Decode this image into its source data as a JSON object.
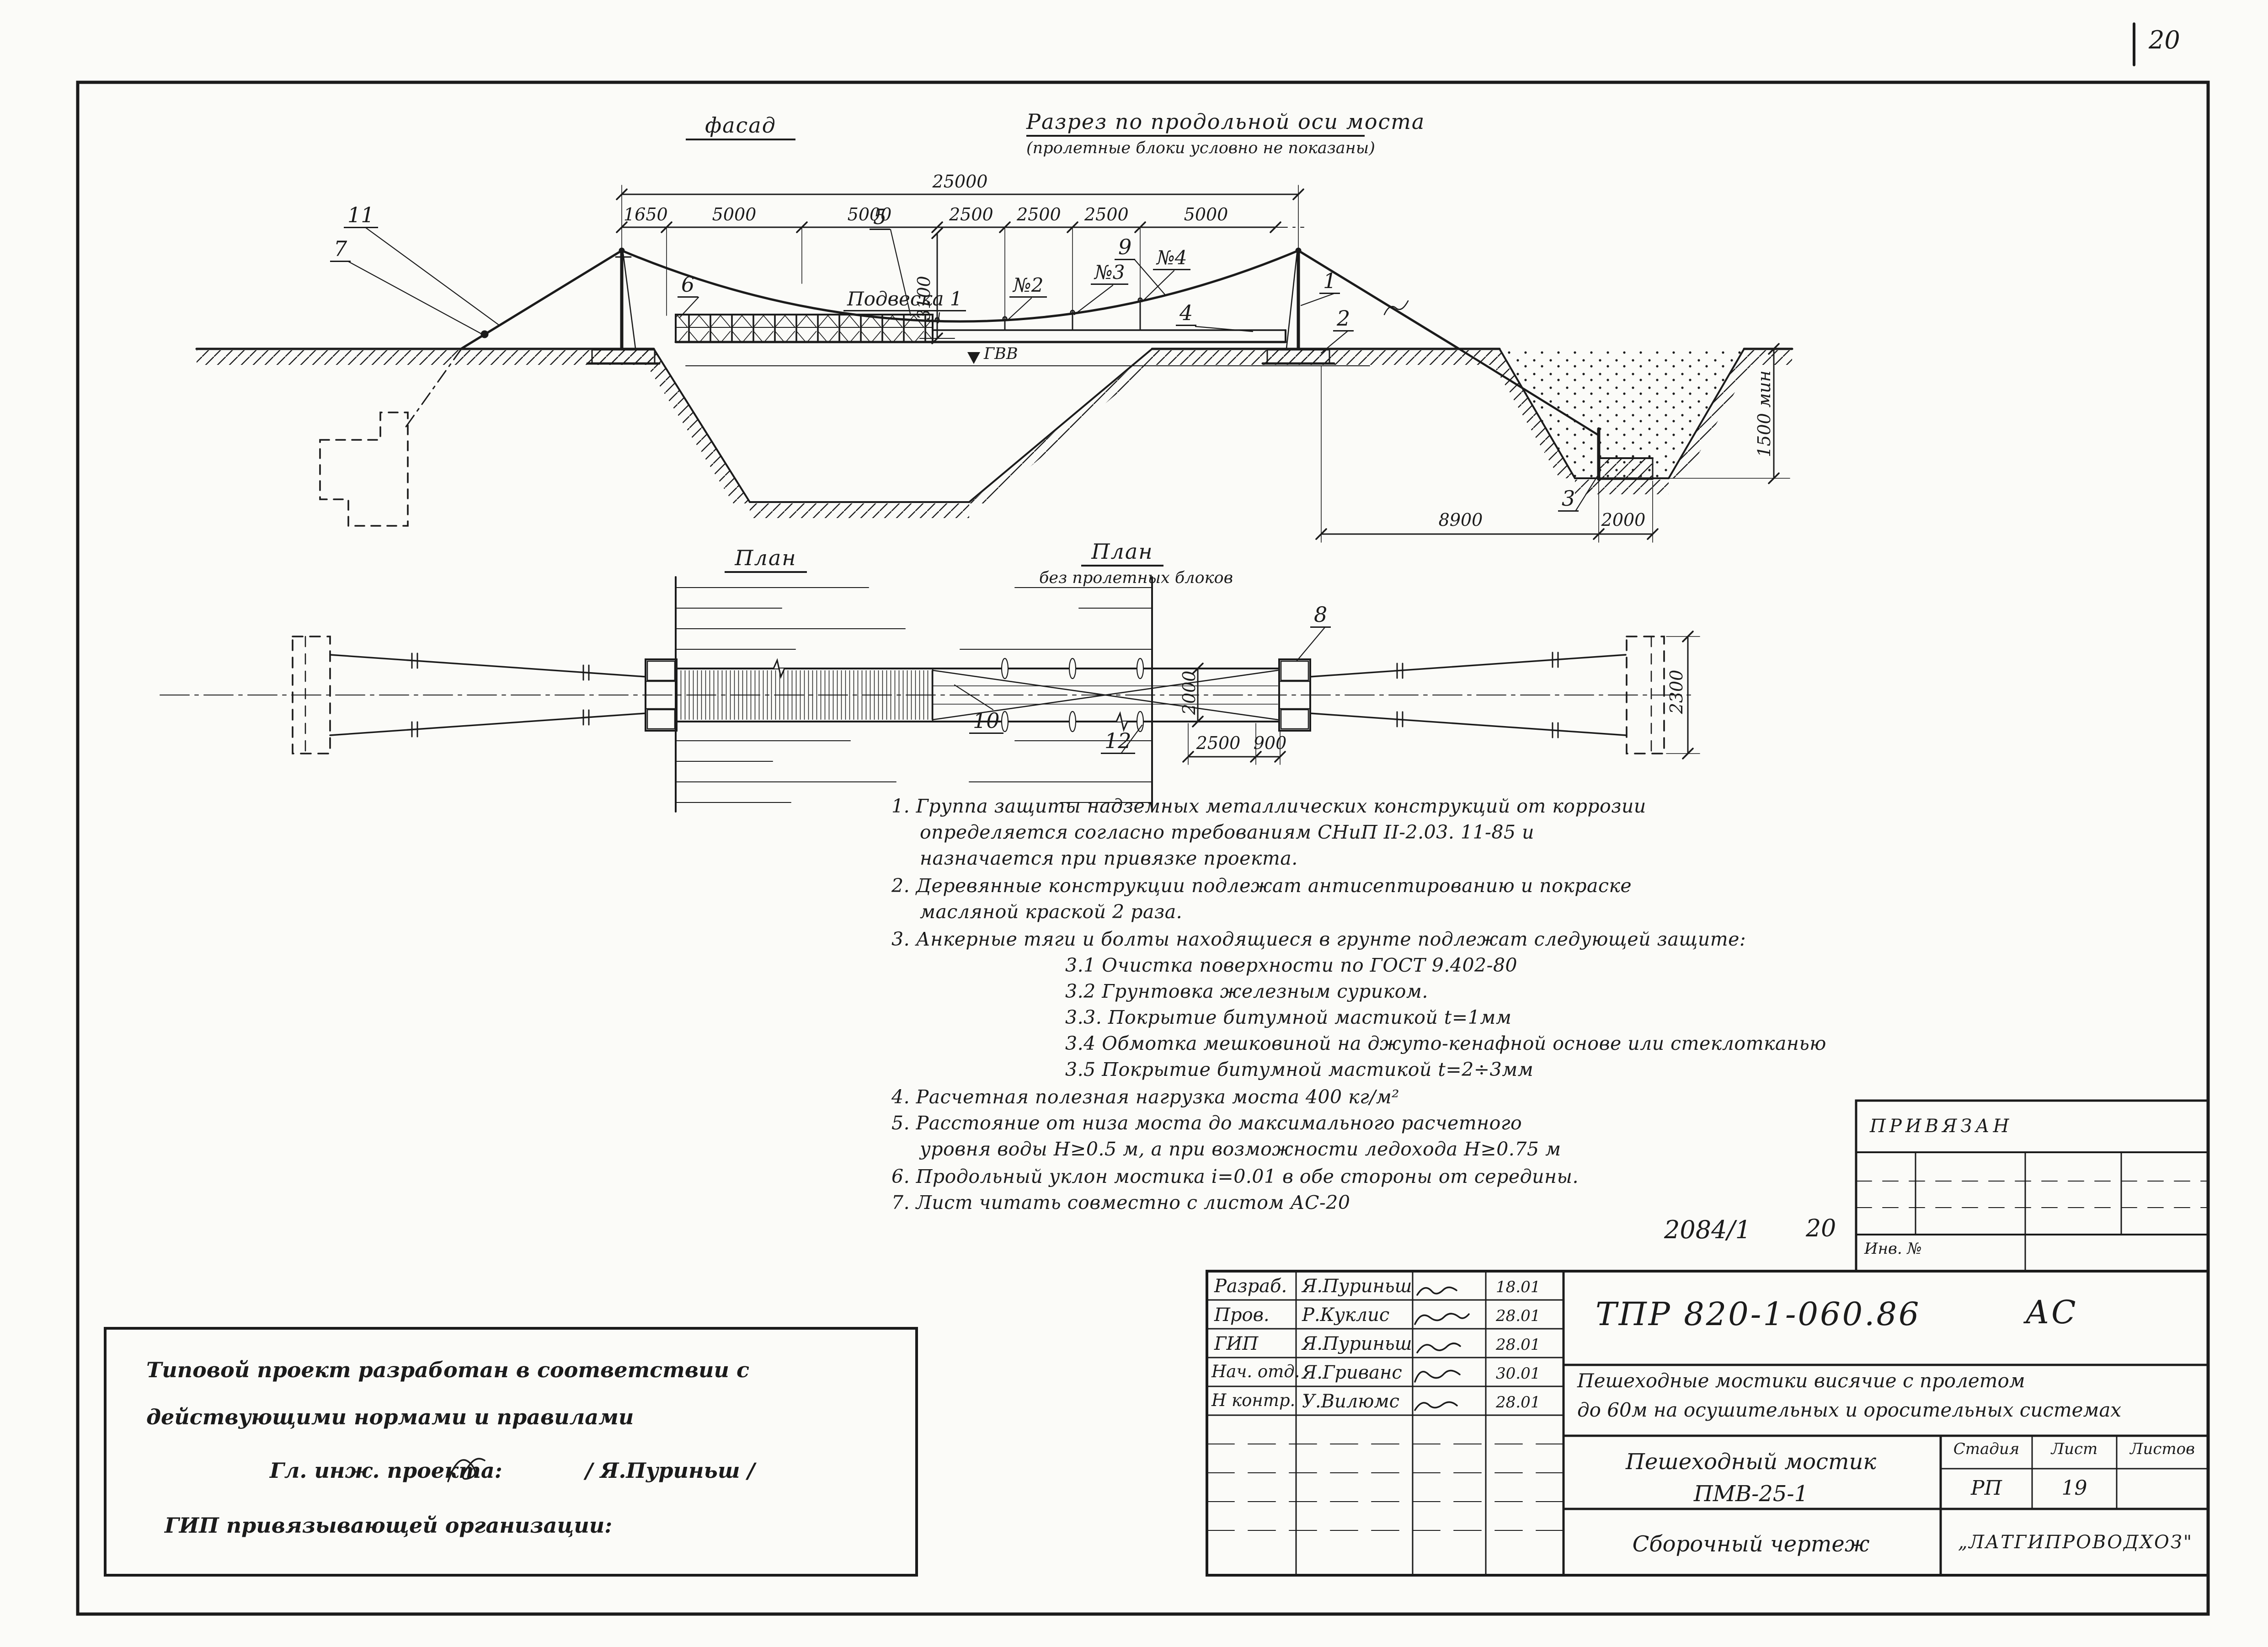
{
  "corner": {
    "sheet_no": "20",
    "doc_no": "2084/1",
    "inv_label": "Инв. №",
    "attached": "ПРИВЯЗАН"
  },
  "views": {
    "facade_title": "фасад",
    "section_title": "Разрез по продольной оси моста",
    "section_subtitle": "(пролетные блоки условно не показаны)",
    "plan_left_title": "План",
    "plan_right_title": "План",
    "plan_right_subtitle": "без пролетных блоков"
  },
  "dims": {
    "total": "25000",
    "segments": [
      "1650",
      "5000",
      "5000",
      "2500",
      "2500",
      "2500",
      "5000"
    ],
    "pylon_height": "3100",
    "pit_offset": "8900",
    "pit_width": "2000",
    "pit_depth": "1500 мин",
    "water_level": "ГВВ",
    "plan_deck_width": "2000",
    "plan_900": "900",
    "plan_2500": "2500",
    "plan_anchor": "2300"
  },
  "parts": {
    "n1": "1",
    "n2": "2",
    "n3": "3",
    "n4": "4",
    "n5": "5",
    "n6": "6",
    "n7": "7",
    "n8": "8",
    "n9": "9",
    "n10": "10",
    "n11": "11",
    "n12": "12",
    "hanger1": "Подвеска 1",
    "hanger2": "№2",
    "hanger3": "№3",
    "hanger4": "№4"
  },
  "notes": {
    "lines": [
      "1.  Группа защиты надземных металлических конструкций от коррозии",
      "определяется согласно требованиям СНиП II-2.03. 11-85 и",
      "назначается при привязке проекта.",
      "2.  Деревянные конструкции подлежат антисептированию и покраске",
      "масляной краской 2 раза.",
      "3.  Анкерные тяги и болты находящиеся в грунте подлежат следующей защите:",
      "3.1 Очистка поверхности по ГОСТ 9.402-80",
      "3.2 Грунтовка железным суриком.",
      "3.3. Покрытие битумной мастикой t=1мм",
      "3.4 Обмотка мешковиной на джуто-кенафной основе или стеклотканью",
      "3.5 Покрытие битумной мастикой t=2÷3мм",
      "4.  Расчетная полезная нагрузка моста 400 кг/м²",
      "5.  Расстояние от низа моста до максимального расчетного",
      "уровня воды Н≥0.5 м, а при возможности ледохода Н≥0.75 м",
      "6.  Продольный уклон мостика i=0.01 в обе стороны от середины.",
      "7.  Лист читать совместно с листом АС-20"
    ]
  },
  "title_block": {
    "doc_code": "ТПР 820-1-060.86",
    "doc_mark": "АС",
    "project_line1": "Пешеходные мостики висячие с пролетом",
    "project_line2": "до 60м на осушительных и оросительных системах",
    "object_line1": "Пешеходный мостик",
    "object_line2": "ПМВ-25-1",
    "drawing_type": "Сборочный чертеж",
    "organization": "„ЛАТГИПРОВОДХОЗ\"",
    "stage_label": "Стадия",
    "sheet_label": "Лист",
    "sheets_label": "Листов",
    "stage": "РП",
    "sheet": "19",
    "sheets": "",
    "rows": [
      {
        "role": "Разраб.",
        "name": "Я.Пуриньш",
        "date": "18.01"
      },
      {
        "role": "Пров.",
        "name": "Р.Куклис",
        "date": "28.01"
      },
      {
        "role": "ГИП",
        "name": "Я.Пуриньш",
        "date": "28.01"
      },
      {
        "role": "Нач. отд.",
        "name": "Я.Гриванс",
        "date": "30.01"
      },
      {
        "role": "Н контр.",
        "name": "У.Вилюмс",
        "date": "28.01"
      }
    ]
  },
  "left_stamp": {
    "line1": "Типовой проект разработан в соответствии с",
    "line2": "действующими нормами и правилами",
    "line3": "Гл. инж. проекта:",
    "line3b": "/ Я.Пуриньш /",
    "line4": "ГИП привязывающей организации:"
  }
}
